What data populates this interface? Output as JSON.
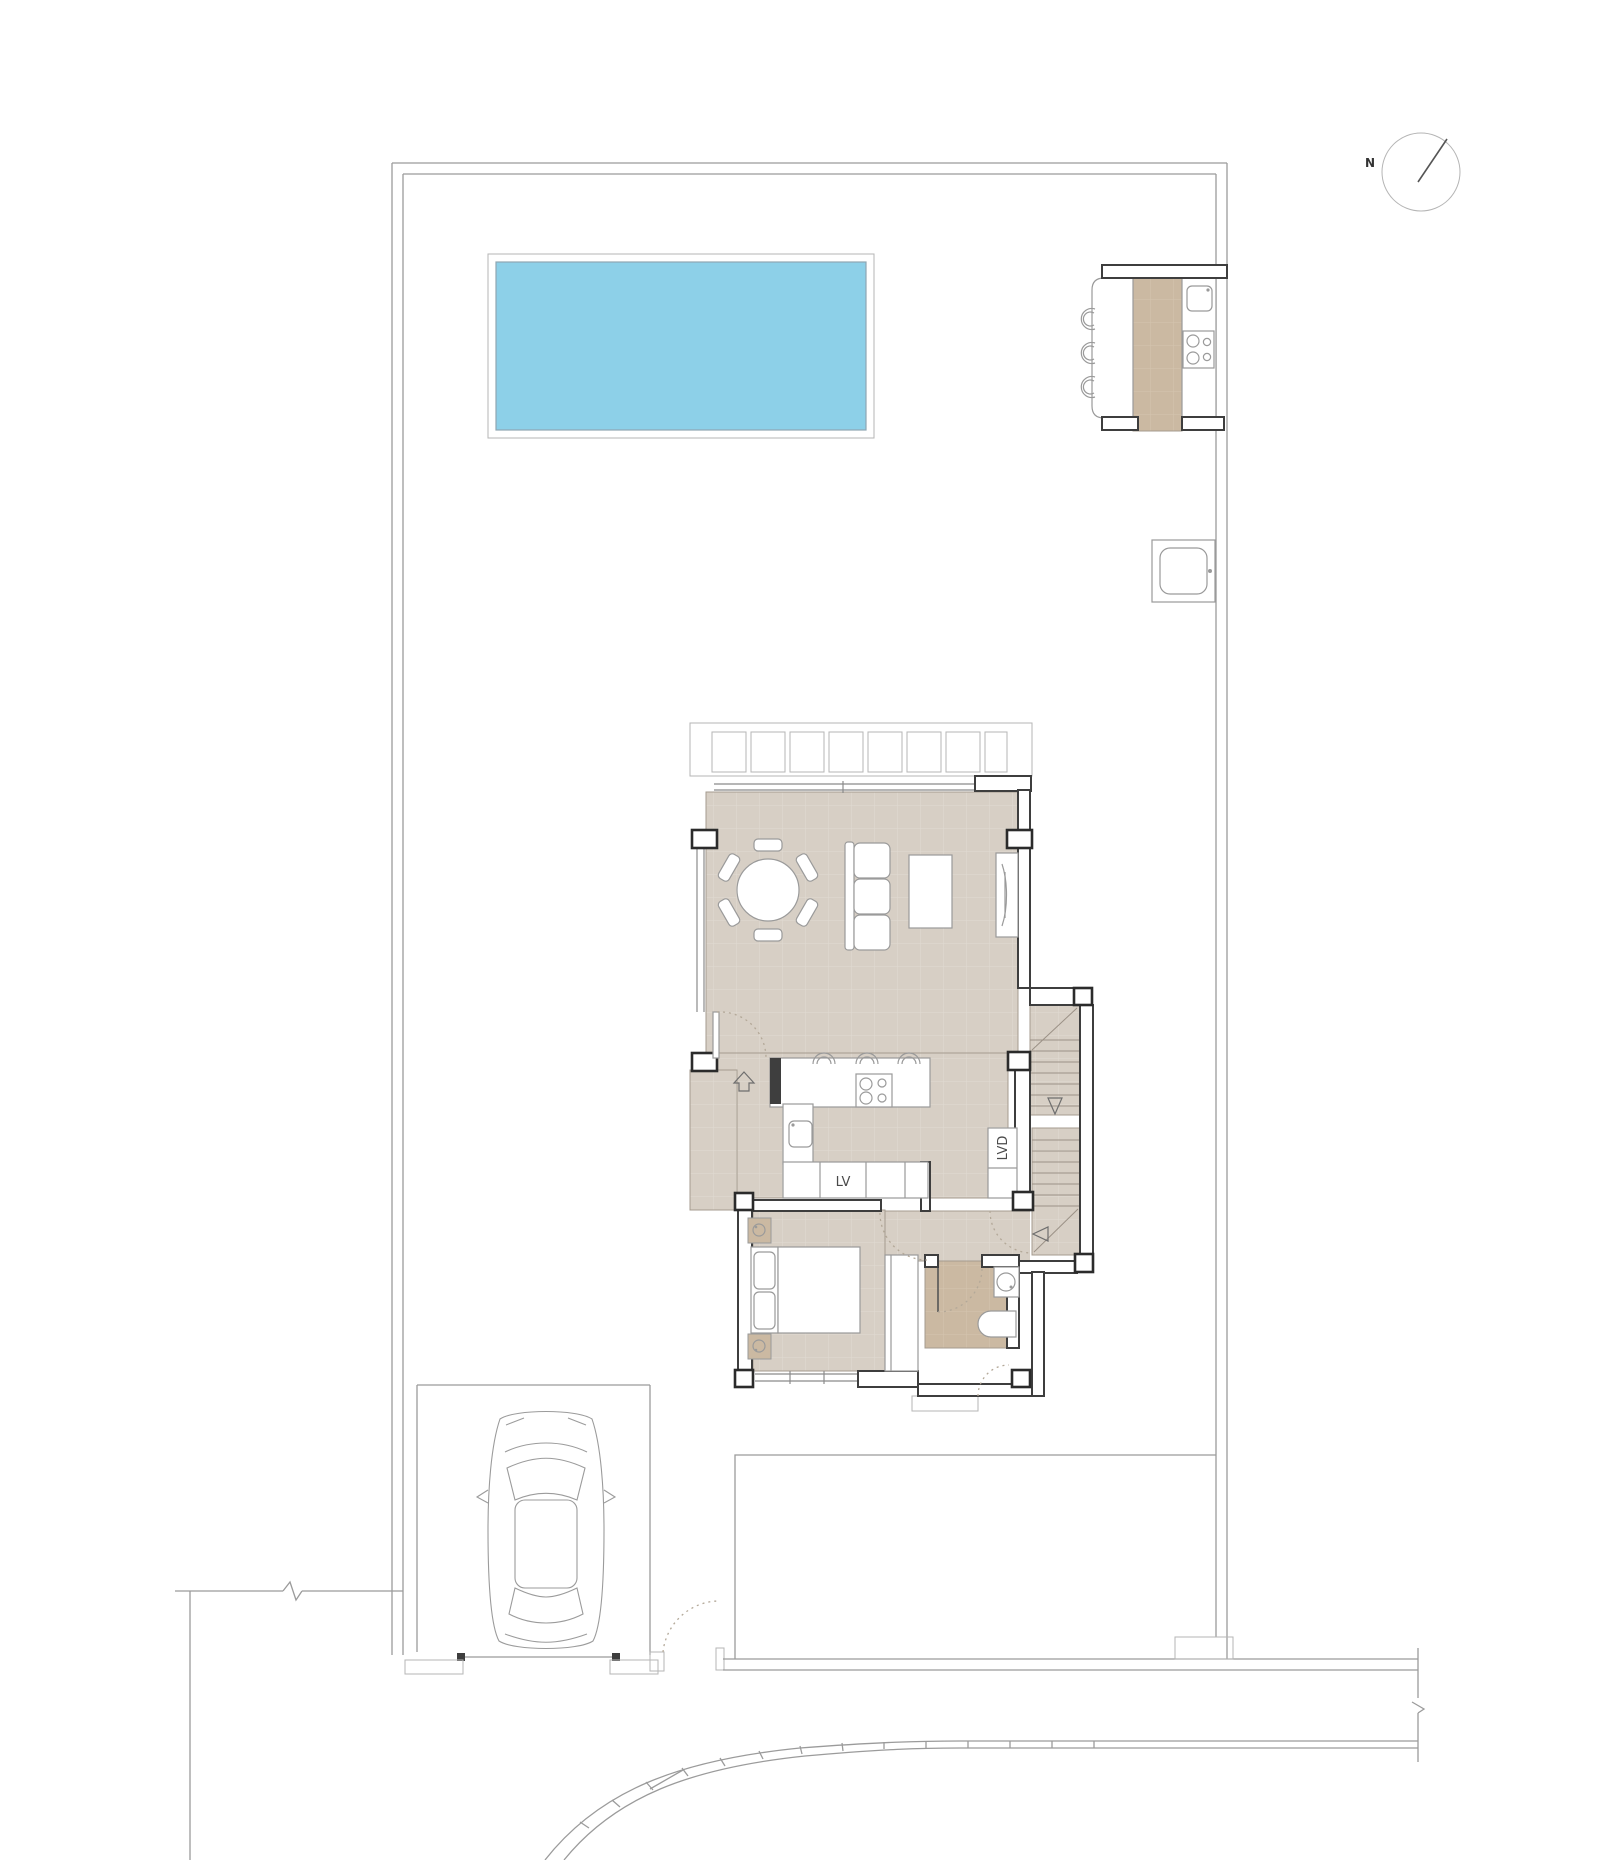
{
  "labels": {
    "north": "N",
    "dishwasher": "LV",
    "washer": "LVD"
  },
  "colors": {
    "bg": "#ffffff",
    "floor": "#d7cfc5",
    "floor_grid": "#e1dbd2",
    "tan": "#cbb9a2",
    "tan_grid": "#d5c5b0",
    "pool": "#8dd0e8",
    "wall_dark": "#3e3e3e",
    "line_gray": "#9b9b9b"
  }
}
